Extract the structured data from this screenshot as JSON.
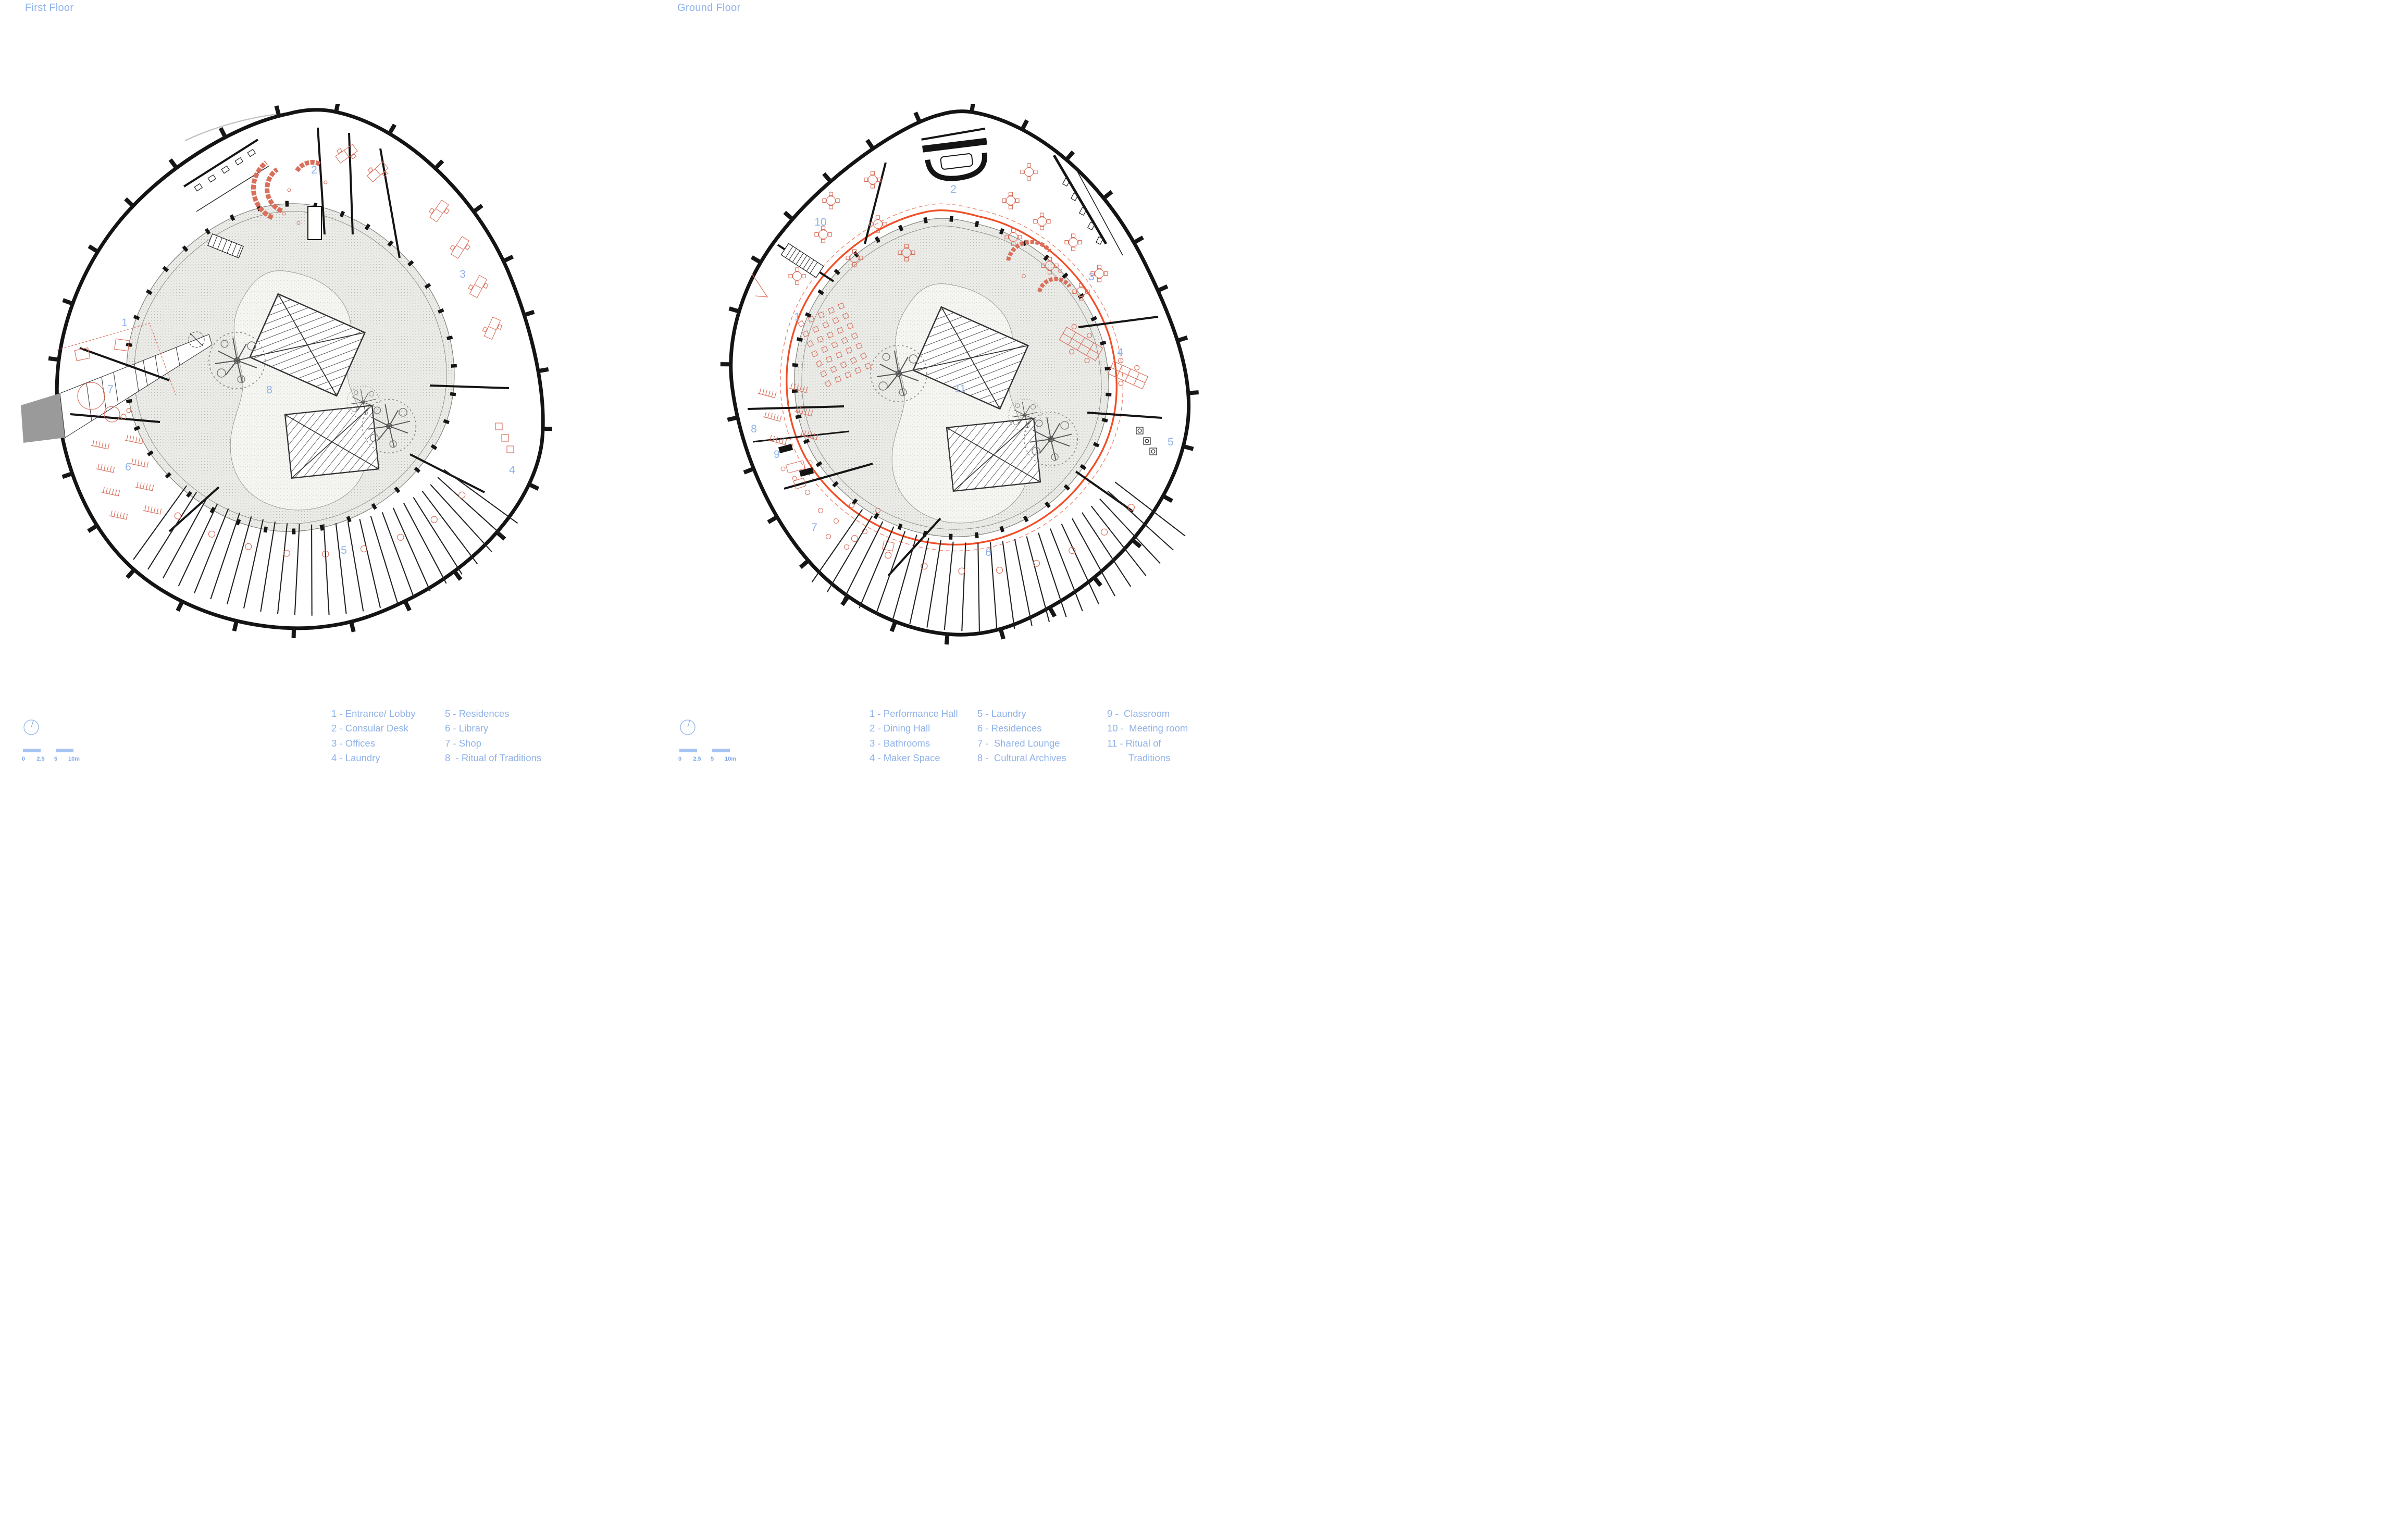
{
  "first_floor": {
    "title": "First Floor",
    "markers": [
      "1",
      "2",
      "3",
      "4",
      "5",
      "6",
      "7",
      "8"
    ],
    "legend": [
      "1 - Entrance/ Lobby",
      "2 - Consular Desk",
      "3 - Offices",
      "4 - Laundry",
      "5 - Residences",
      "6 - Library",
      "7 - Shop",
      "8  - Ritual of Traditions"
    ]
  },
  "ground_floor": {
    "title": "Ground Floor",
    "markers": [
      "1",
      "2",
      "3",
      "4",
      "5",
      "6",
      "7",
      "8",
      "9",
      "10",
      "11"
    ],
    "legend": [
      "1 - Performance Hall",
      "2 - Dining Hall",
      "3 - Bathrooms",
      "4 - Maker Space",
      "5 - Laundry",
      "6 - Residences",
      "7 -  Shared Lounge",
      "8 -  Cultural Archives",
      "9 -  Classroom",
      "10 -  Meeting room",
      "11 - Ritual of\n        Traditions"
    ]
  },
  "scale_bar": {
    "labels": [
      "0",
      "2.5",
      "5",
      "10m"
    ]
  },
  "colors": {
    "label_blue": "#8fb2ea",
    "scale_blue": "#a6c3f2",
    "furniture_red": "#d9705c",
    "screen_orange": "#f04f28",
    "wall_black": "#141414",
    "courtyard_gray": "#ebebe8"
  }
}
